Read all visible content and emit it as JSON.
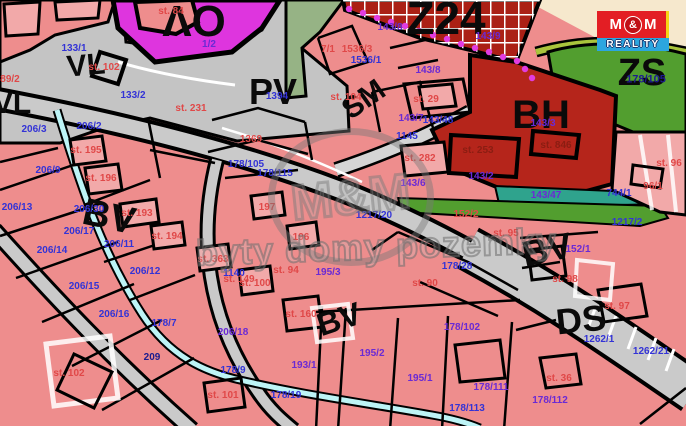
{
  "map": {
    "colors": {
      "parcel_pink": "#ee8d8d",
      "parcel_pink_light": "#f2a9a9",
      "zone_gray": "#c4c4c4",
      "road_gray": "#cacaca",
      "ov_magenta": "#de35de",
      "bh_red": "#b5251b",
      "z24_red": "#ab2015",
      "zs_green": "#529e2f",
      "sage_green": "#96b385",
      "olive": "#a9c43c",
      "teal": "#2fa38d",
      "stream_cyan": "#bdf4f6",
      "cream": "#f6e8cd",
      "dot_magenta": "#e13ce1",
      "label_blue": "#3333d6",
      "label_violet": "#6a2ad4",
      "label_red": "#e04848",
      "label_darkred": "#8b1d12",
      "label_navy": "#1c1c8e",
      "logo_red": "#e31e24",
      "logo_blue": "#2ca6df",
      "logo_yellow": "#f5d415"
    },
    "watermark": {
      "text": "byty domy pozemky",
      "logo_text": "M&M"
    },
    "brand": {
      "m_left": "M",
      "amp": "&",
      "m_right": "M",
      "reality": "REALITY"
    },
    "zone_labels": [
      {
        "text": "VL",
        "x": 86,
        "y": 66,
        "size": 30,
        "rot": -5
      },
      {
        "text": "VL",
        "x": 12,
        "y": 104,
        "size": 30,
        "rot": 0
      },
      {
        "text": "OV",
        "x": 194,
        "y": 20,
        "size": 44,
        "rot": 180
      },
      {
        "text": "PV",
        "x": 273,
        "y": 92,
        "size": 36,
        "rot": 0
      },
      {
        "text": "SM",
        "x": 364,
        "y": 100,
        "size": 30,
        "rot": -35
      },
      {
        "text": "Z24",
        "x": 446,
        "y": 18,
        "size": 46,
        "rot": 0,
        "weight": 900
      },
      {
        "text": "BH",
        "x": 541,
        "y": 115,
        "size": 40,
        "rot": 0
      },
      {
        "text": "ZS",
        "x": 642,
        "y": 73,
        "size": 38,
        "rot": 0
      },
      {
        "text": "BV",
        "x": 109,
        "y": 217,
        "size": 38,
        "rot": 12
      },
      {
        "text": "BV",
        "x": 339,
        "y": 319,
        "size": 32,
        "rot": -18
      },
      {
        "text": "BV",
        "x": 547,
        "y": 250,
        "size": 36,
        "rot": -12
      },
      {
        "text": "DS",
        "x": 581,
        "y": 320,
        "size": 36,
        "rot": -6
      }
    ],
    "parcel_labels": [
      {
        "text": "133/1",
        "x": 74,
        "y": 49,
        "color": "blue"
      },
      {
        "text": "133/2",
        "x": 133,
        "y": 96,
        "color": "blue"
      },
      {
        "text": "1394",
        "x": 277,
        "y": 97,
        "color": "blue"
      },
      {
        "text": "206/2",
        "x": 89,
        "y": 127,
        "color": "blue"
      },
      {
        "text": "206/3",
        "x": 34,
        "y": 130,
        "color": "blue"
      },
      {
        "text": "206/9",
        "x": 48,
        "y": 171,
        "color": "blue"
      },
      {
        "text": "206/13",
        "x": 17,
        "y": 208,
        "color": "blue"
      },
      {
        "text": "206/30",
        "x": 89,
        "y": 210,
        "color": "blue"
      },
      {
        "text": "206/17",
        "x": 79,
        "y": 232,
        "color": "blue"
      },
      {
        "text": "206/11",
        "x": 119,
        "y": 245,
        "color": "blue"
      },
      {
        "text": "206/14",
        "x": 52,
        "y": 251,
        "color": "blue"
      },
      {
        "text": "206/12",
        "x": 145,
        "y": 272,
        "color": "blue"
      },
      {
        "text": "206/15",
        "x": 84,
        "y": 287,
        "color": "blue"
      },
      {
        "text": "206/16",
        "x": 114,
        "y": 315,
        "color": "blue"
      },
      {
        "text": "178/105",
        "x": 246,
        "y": 165,
        "color": "blue"
      },
      {
        "text": "178/115",
        "x": 275,
        "y": 174,
        "color": "blue"
      },
      {
        "text": "1536/1",
        "x": 366,
        "y": 61,
        "color": "blue"
      },
      {
        "text": "143/48",
        "x": 438,
        "y": 121,
        "color": "blue"
      },
      {
        "text": "1145",
        "x": 407,
        "y": 137,
        "color": "blue"
      },
      {
        "text": "1217/20",
        "x": 374,
        "y": 216,
        "color": "blue"
      },
      {
        "text": "178/28",
        "x": 457,
        "y": 267,
        "color": "blue"
      },
      {
        "text": "1217/2",
        "x": 627,
        "y": 223,
        "color": "blue"
      },
      {
        "text": "1262/1",
        "x": 599,
        "y": 340,
        "color": "blue"
      },
      {
        "text": "1262/21",
        "x": 651,
        "y": 352,
        "color": "blue"
      },
      {
        "text": "744/1",
        "x": 619,
        "y": 194,
        "color": "blue"
      },
      {
        "text": "178/7",
        "x": 164,
        "y": 324,
        "color": "blue"
      },
      {
        "text": "178/9",
        "x": 233,
        "y": 371,
        "color": "blue"
      },
      {
        "text": "178/19",
        "x": 286,
        "y": 396,
        "color": "blue"
      },
      {
        "text": "178/113",
        "x": 467,
        "y": 409,
        "color": "blue"
      },
      {
        "text": "1140",
        "x": 234,
        "y": 274,
        "color": "blue"
      },
      {
        "text": "209",
        "x": 152,
        "y": 358,
        "color": "navy"
      },
      {
        "text": "178/105",
        "x": 646,
        "y": 80,
        "color": "navy",
        "size": 11
      },
      {
        "text": "1/2",
        "x": 209,
        "y": 45,
        "color": "violet"
      },
      {
        "text": "143/8",
        "x": 390,
        "y": 28,
        "color": "violet"
      },
      {
        "text": "143/8",
        "x": 428,
        "y": 71,
        "color": "violet"
      },
      {
        "text": "143/9",
        "x": 488,
        "y": 37,
        "color": "violet"
      },
      {
        "text": "143/7",
        "x": 411,
        "y": 119,
        "color": "violet"
      },
      {
        "text": "143/2",
        "x": 481,
        "y": 177,
        "color": "violet"
      },
      {
        "text": "143/6",
        "x": 413,
        "y": 184,
        "color": "violet"
      },
      {
        "text": "143/3",
        "x": 543,
        "y": 124,
        "color": "violet"
      },
      {
        "text": "143/47",
        "x": 546,
        "y": 196,
        "color": "violet"
      },
      {
        "text": "195/3",
        "x": 328,
        "y": 273,
        "color": "violet"
      },
      {
        "text": "152/1",
        "x": 578,
        "y": 250,
        "color": "violet"
      },
      {
        "text": "206/18",
        "x": 233,
        "y": 333,
        "color": "violet"
      },
      {
        "text": "193/1",
        "x": 304,
        "y": 366,
        "color": "violet"
      },
      {
        "text": "195/2",
        "x": 372,
        "y": 354,
        "color": "violet"
      },
      {
        "text": "195/1",
        "x": 420,
        "y": 379,
        "color": "violet"
      },
      {
        "text": "178/111",
        "x": 491,
        "y": 388,
        "color": "violet"
      },
      {
        "text": "178/102",
        "x": 462,
        "y": 328,
        "color": "violet"
      },
      {
        "text": "178/112",
        "x": 550,
        "y": 401,
        "color": "violet"
      },
      {
        "text": "89/2",
        "x": 10,
        "y": 80,
        "color": "red"
      },
      {
        "text": "st. 102",
        "x": 104,
        "y": 68,
        "color": "red"
      },
      {
        "text": "st. 84",
        "x": 171,
        "y": 12,
        "color": "red"
      },
      {
        "text": "1536/3",
        "x": 357,
        "y": 50,
        "color": "red"
      },
      {
        "text": "7/1",
        "x": 328,
        "y": 50,
        "color": "red"
      },
      {
        "text": "st. 104",
        "x": 346,
        "y": 98,
        "color": "red"
      },
      {
        "text": "st. 29",
        "x": 426,
        "y": 100,
        "color": "red"
      },
      {
        "text": "st. 282",
        "x": 420,
        "y": 159,
        "color": "red"
      },
      {
        "text": "152/2",
        "x": 466,
        "y": 215,
        "color": "red"
      },
      {
        "text": "st. 95",
        "x": 506,
        "y": 234,
        "color": "red"
      },
      {
        "text": "st. 90",
        "x": 425,
        "y": 284,
        "color": "red"
      },
      {
        "text": "st. 98",
        "x": 565,
        "y": 280,
        "color": "red"
      },
      {
        "text": "st. 97",
        "x": 617,
        "y": 307,
        "color": "red"
      },
      {
        "text": "st. 96",
        "x": 669,
        "y": 164,
        "color": "red"
      },
      {
        "text": "96/1",
        "x": 653,
        "y": 187,
        "color": "red"
      },
      {
        "text": "st. 36",
        "x": 559,
        "y": 379,
        "color": "red"
      },
      {
        "text": "st. 193",
        "x": 137,
        "y": 214,
        "color": "red"
      },
      {
        "text": "st. 194",
        "x": 167,
        "y": 237,
        "color": "red"
      },
      {
        "text": "st. 195",
        "x": 86,
        "y": 151,
        "color": "red"
      },
      {
        "text": "st. 196",
        "x": 101,
        "y": 179,
        "color": "red"
      },
      {
        "text": "197",
        "x": 267,
        "y": 208,
        "color": "red"
      },
      {
        "text": "196",
        "x": 301,
        "y": 238,
        "color": "red"
      },
      {
        "text": "st. 363",
        "x": 213,
        "y": 260,
        "color": "red"
      },
      {
        "text": "st. 149",
        "x": 239,
        "y": 280,
        "color": "red"
      },
      {
        "text": "st. 100",
        "x": 255,
        "y": 284,
        "color": "red"
      },
      {
        "text": "st. 94",
        "x": 286,
        "y": 271,
        "color": "red"
      },
      {
        "text": "st. 102",
        "x": 69,
        "y": 374,
        "color": "red"
      },
      {
        "text": "st. 101",
        "x": 223,
        "y": 396,
        "color": "red"
      },
      {
        "text": "st. 160",
        "x": 301,
        "y": 315,
        "color": "red"
      },
      {
        "text": "st. 231",
        "x": 191,
        "y": 109,
        "color": "red"
      },
      {
        "text": "1369",
        "x": 251,
        "y": 140,
        "color": "red"
      },
      {
        "text": "st. 253",
        "x": 478,
        "y": 151,
        "color": "darkred"
      },
      {
        "text": "st. 846",
        "x": 556,
        "y": 146,
        "color": "darkred"
      }
    ]
  }
}
